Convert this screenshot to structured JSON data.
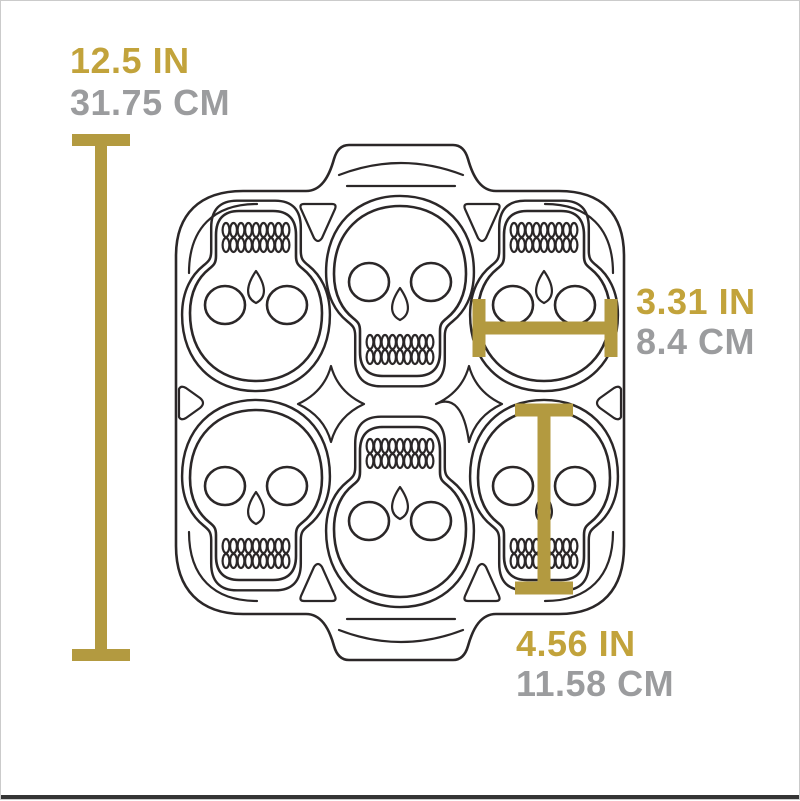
{
  "colors": {
    "accent_gold": "#b39a40",
    "text_gold": "#c2a33b",
    "text_gray": "#9b9c9e",
    "line": "#2b2728",
    "background": "#ffffff",
    "bottom_bar": "#353535"
  },
  "illustration": {
    "subject": "cast iron skull baking pan, top view line drawing",
    "cavities": 6,
    "rows": 2,
    "columns": 3
  },
  "dimensions": {
    "overall_height": {
      "inches": "12.5 IN",
      "centimeters": "31.75 CM"
    },
    "cavity_width": {
      "inches": "3.31 IN",
      "centimeters": "8.4 CM"
    },
    "cavity_height": {
      "inches": "4.56 IN",
      "centimeters": "11.58 CM"
    }
  }
}
